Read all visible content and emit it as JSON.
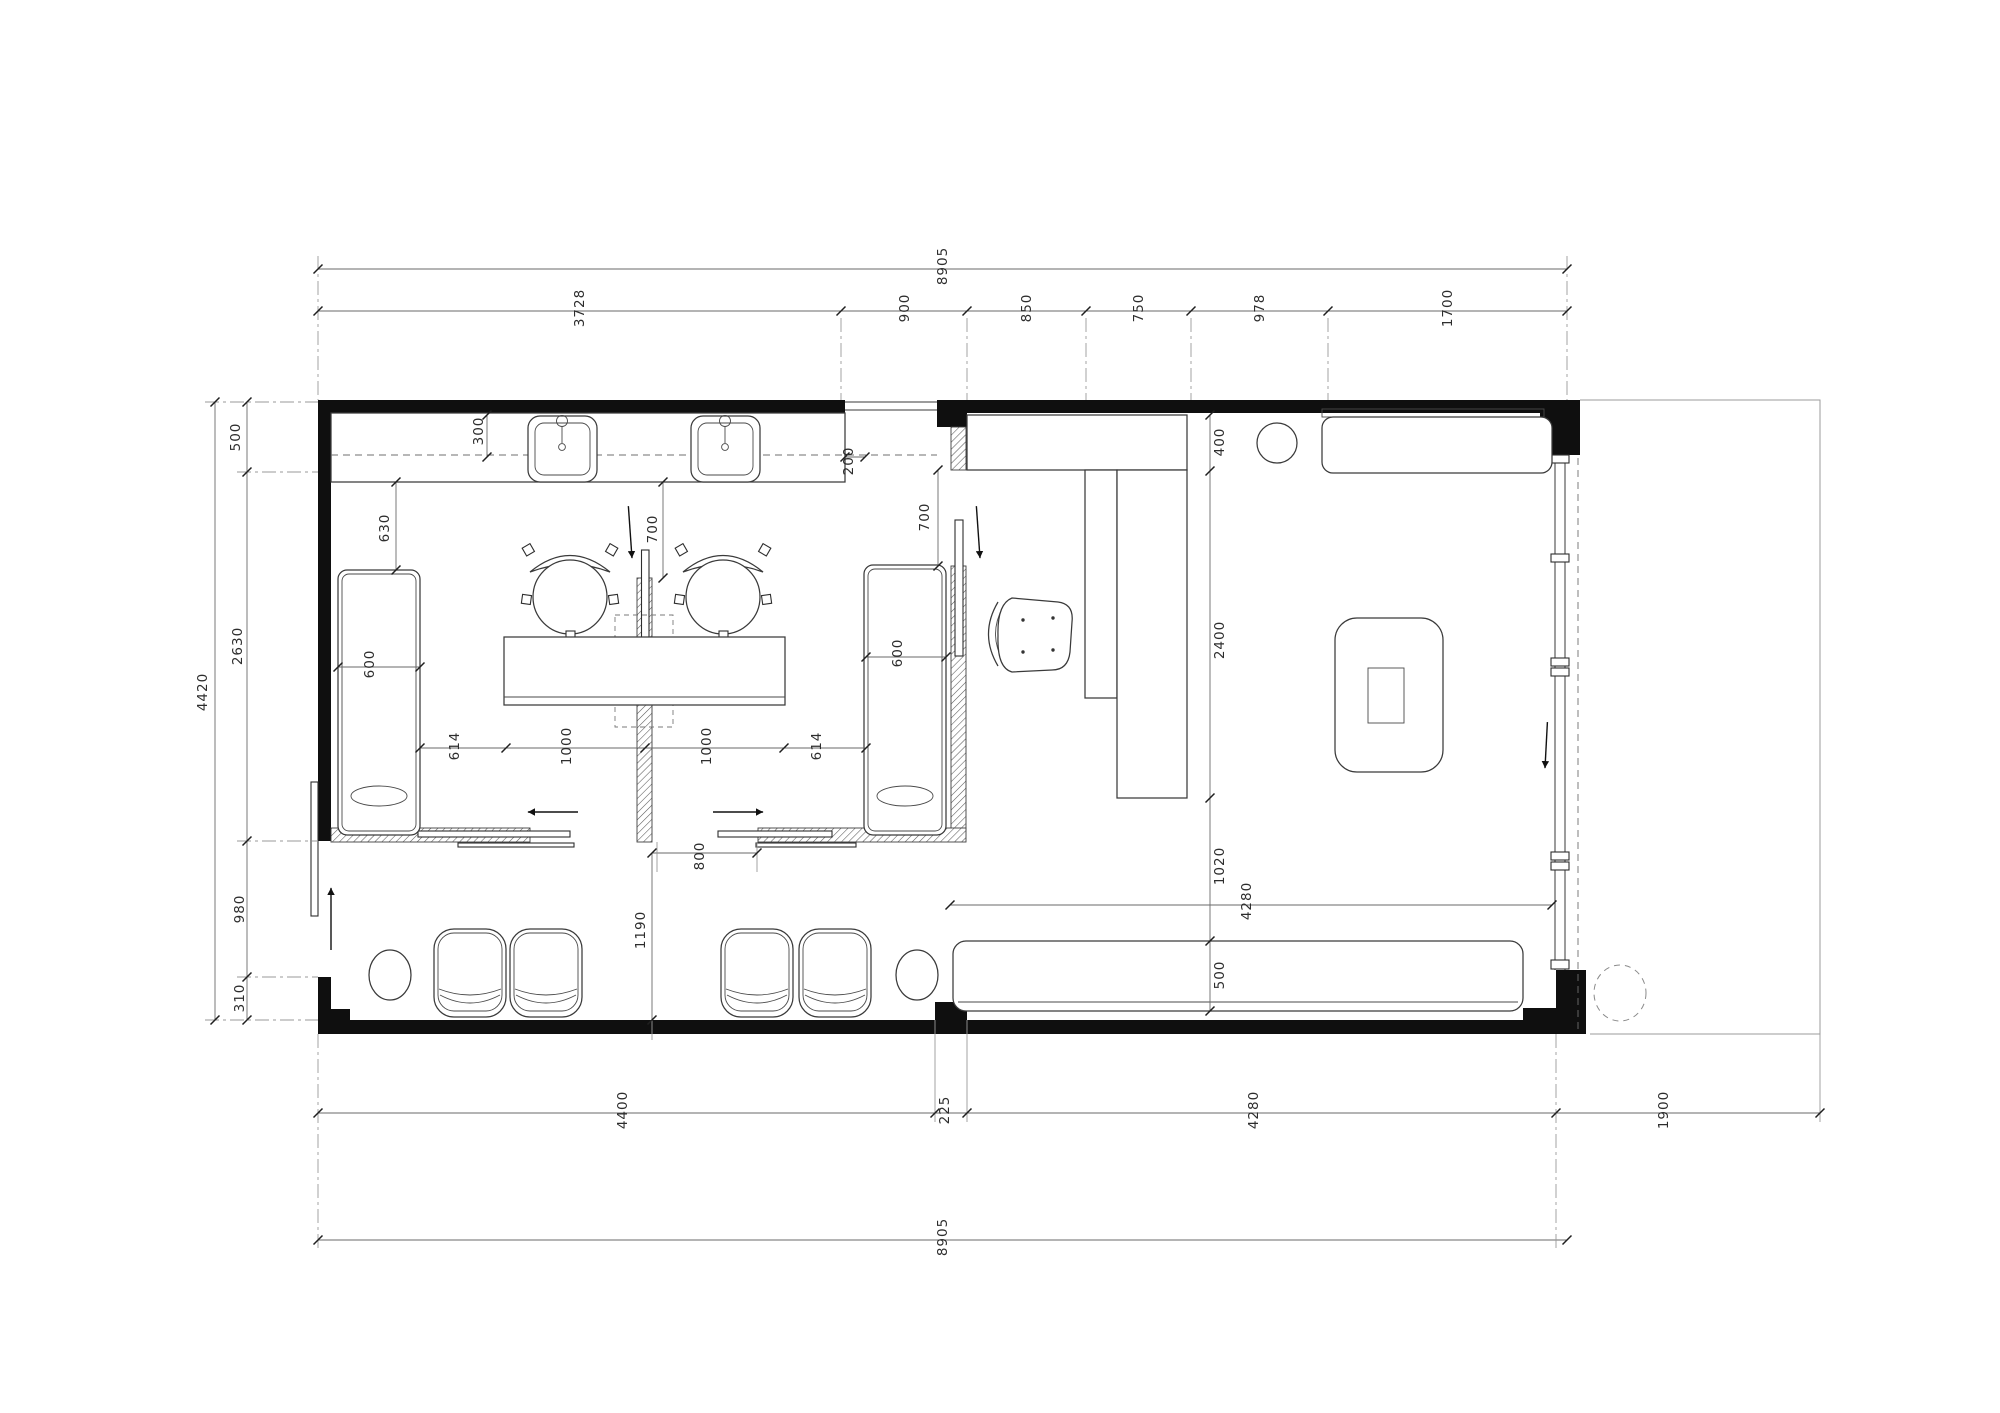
{
  "document": {
    "type": "architectural-floor-plan",
    "view": "top-down plan of a small clinic / salon suite with two treatment rooms, corridor waiting area and reception lounge",
    "units": "mm",
    "background_color": "#ffffff",
    "wall_color": "#0f0f0f",
    "line_color": "#3a3a3a",
    "dim_color": "#2d2d2d"
  },
  "dimensions": {
    "unit": "mm",
    "top_overall": "8905",
    "top_chain": [
      "3728",
      "900",
      "850",
      "750",
      "978",
      "1700"
    ],
    "left_overall": "4420",
    "left_chain": [
      "500",
      "2630",
      "980",
      "310"
    ],
    "bottom_chain": [
      "4400",
      "225",
      "4280"
    ],
    "bottom_overall": "8905",
    "right_extension": "1900",
    "interior": [
      "300",
      "630",
      "600",
      "700",
      "200",
      "700",
      "400",
      "2400",
      "614",
      "1000",
      "1000",
      "614",
      "600",
      "800",
      "1190",
      "1020",
      "4280",
      "500"
    ]
  },
  "dim_labels": [
    {
      "t": "8905",
      "x": 947,
      "y": 266
    },
    {
      "t": "3728",
      "x": 584,
      "y": 308
    },
    {
      "t": "900",
      "x": 909,
      "y": 308
    },
    {
      "t": "850",
      "x": 1031,
      "y": 308
    },
    {
      "t": "750",
      "x": 1143,
      "y": 308
    },
    {
      "t": "978",
      "x": 1264,
      "y": 308
    },
    {
      "t": "1700",
      "x": 1452,
      "y": 308
    },
    {
      "t": "4420",
      "x": 207,
      "y": 692
    },
    {
      "t": "500",
      "x": 240,
      "y": 437
    },
    {
      "t": "2630",
      "x": 242,
      "y": 646
    },
    {
      "t": "980",
      "x": 244,
      "y": 909
    },
    {
      "t": "310",
      "x": 244,
      "y": 998
    },
    {
      "t": "300",
      "x": 483,
      "y": 431
    },
    {
      "t": "630",
      "x": 389,
      "y": 528
    },
    {
      "t": "600",
      "x": 374,
      "y": 664
    },
    {
      "t": "700",
      "x": 657,
      "y": 529
    },
    {
      "t": "200",
      "x": 853,
      "y": 461
    },
    {
      "t": "700",
      "x": 929,
      "y": 517
    },
    {
      "t": "614",
      "x": 459,
      "y": 746
    },
    {
      "t": "1000",
      "x": 571,
      "y": 746
    },
    {
      "t": "1000",
      "x": 711,
      "y": 746
    },
    {
      "t": "614",
      "x": 821,
      "y": 746
    },
    {
      "t": "600",
      "x": 902,
      "y": 653
    },
    {
      "t": "800",
      "x": 704,
      "y": 856
    },
    {
      "t": "1190",
      "x": 645,
      "y": 930
    },
    {
      "t": "400",
      "x": 1224,
      "y": 442
    },
    {
      "t": "2400",
      "x": 1224,
      "y": 640
    },
    {
      "t": "1020",
      "x": 1224,
      "y": 866
    },
    {
      "t": "4280",
      "x": 1251,
      "y": 901
    },
    {
      "t": "500",
      "x": 1224,
      "y": 975
    },
    {
      "t": "4400",
      "x": 627,
      "y": 1110
    },
    {
      "t": "225",
      "x": 949,
      "y": 1110
    },
    {
      "t": "4280",
      "x": 1258,
      "y": 1110
    },
    {
      "t": "1900",
      "x": 1668,
      "y": 1110
    },
    {
      "t": "8905",
      "x": 947,
      "y": 1237
    }
  ]
}
